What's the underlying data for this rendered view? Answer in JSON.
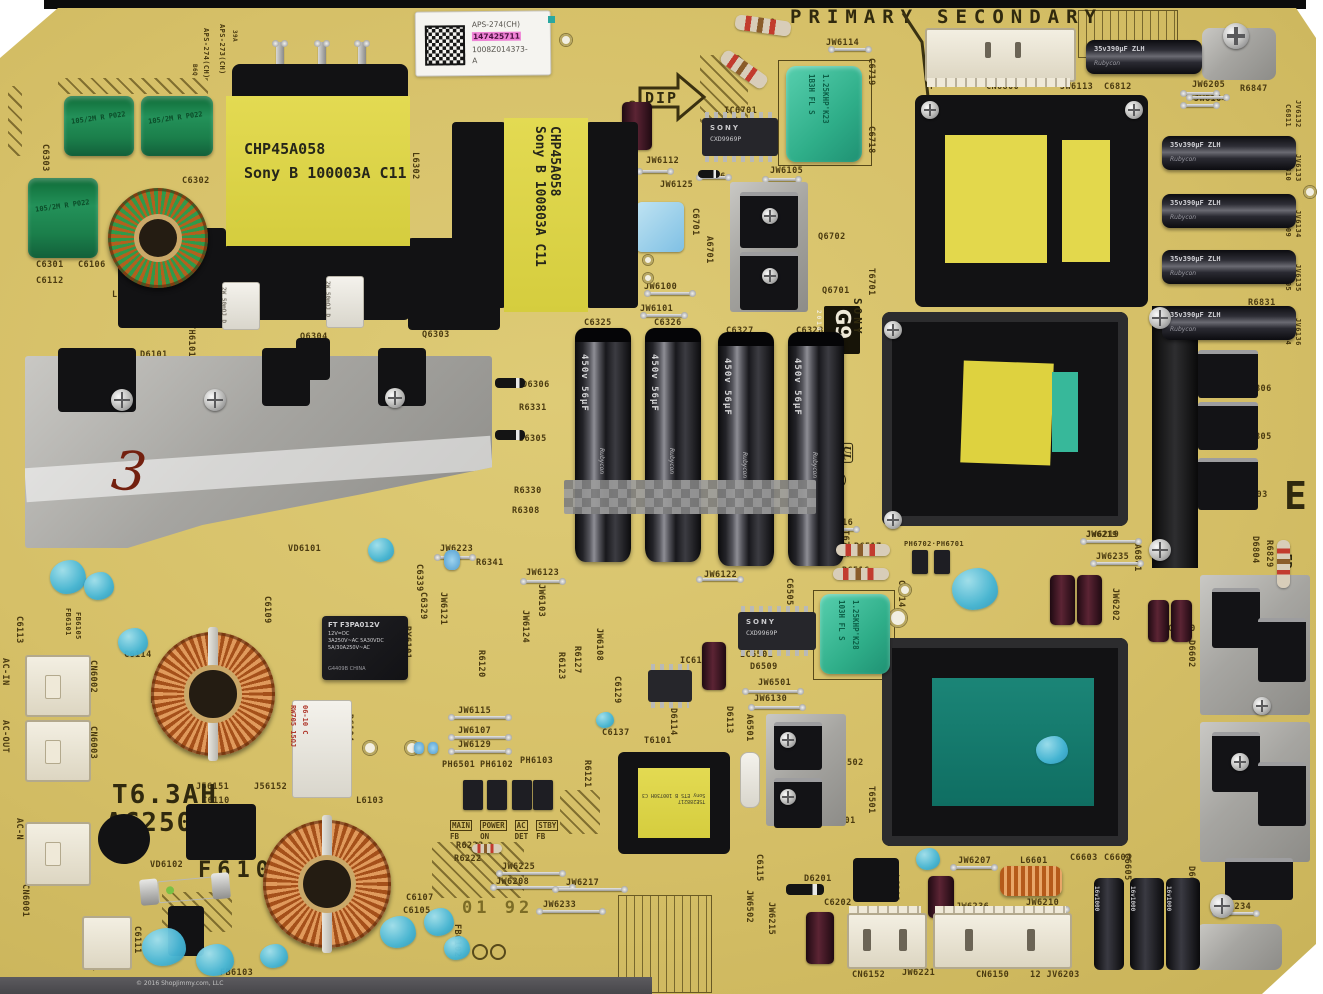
{
  "silk_large": {
    "primary": "PRIMARY",
    "secondary": "SECONDARY",
    "dip": "DIP",
    "big_e": "E",
    "edge_code": ">EP GW LP<",
    "fuse_rating": "T6.3AH",
    "fuse_voltage": "AC250V",
    "fuse_ref": "F6101",
    "date_stamp": "01 92",
    "g_block": {
      "g9": "G9",
      "year": "2010",
      "brand": "SONY",
      "model": "APS-273",
      "number": "1-882-846-11",
      "ul": "UL",
      "cert": "A"
    }
  },
  "sticker": {
    "line1": "APS-274(CH)",
    "serial": "147425711",
    "line3": "1008Z014373-",
    "line4": "A"
  },
  "handwriting": {
    "mark": "3"
  },
  "watermark": "© 2016 ShopJimmy.com, LLC",
  "components": {
    "t6302": {
      "line1": "CHP45A058",
      "line2": "Sony B 100003A C11"
    },
    "t6303": {
      "line1": "CHP45A058",
      "line2": "Sony B 100803A C11"
    },
    "t6101": {
      "line1": "TSE288217",
      "line2": "Sony ETS B 100730H C3"
    },
    "ic6701": {
      "brand": "SONY",
      "part": "CXD9969P"
    },
    "ic6501": {
      "brand": "SONY",
      "part": "CXD9969P"
    },
    "relay": {
      "l1": "FT F3PA012V",
      "l2": "12V=DC",
      "l3": "3A250V~AC  5A30VDC",
      "l4": "5A/30A250V~AC",
      "l5": "G4409B   CHINA"
    },
    "bulk_caps": {
      "brand": "Rubycon",
      "marking": "450v 56µF",
      "refs": [
        "C6325",
        "C6326",
        "C6327",
        "C6328"
      ]
    },
    "output_caps": {
      "brand": "Rubycon",
      "marking": "35v390µF",
      "series": "ZLH"
    },
    "small_caps": {
      "brand": "Rubycon",
      "marking": "16v1000"
    },
    "film_cap_marking": "105/2M R P022",
    "teal_cap_top": {
      "l1": "1B3H FL S",
      "l2": "1.25KHP'K23"
    },
    "teal_cap_mid": {
      "l1": "103H FL S",
      "l2": "1.25KHP'K28"
    },
    "power_resistor": "2W 50mΩJ D",
    "ceramic_resistor": {
      "l1": "RW705 15ΩJ",
      "l2": "06-10 C"
    }
  },
  "opto_labels": {
    "main": "MAIN",
    "fb1": "FB",
    "power": "POWER",
    "on": "ON",
    "ac": "AC",
    "det": "DET",
    "stby": "STBY",
    "fb2": "FB"
  },
  "silkscreen_labels": [
    {
      "t": "R6729",
      "x": 748,
      "y": 18
    },
    {
      "t": "JW6114",
      "x": 826,
      "y": 38
    },
    {
      "t": "C6719",
      "x": 876,
      "y": 58,
      "r": 90
    },
    {
      "t": "C6718",
      "x": 876,
      "y": 126,
      "r": 90
    },
    {
      "t": "L6303",
      "x": 958,
      "y": 38
    },
    {
      "t": "ET6801",
      "x": 1248,
      "y": 28,
      "r": 90
    },
    {
      "t": "↑",
      "x": 1212,
      "y": 52,
      "s": 13
    },
    {
      "t": "CN6800",
      "x": 986,
      "y": 82
    },
    {
      "t": "F",
      "x": 930,
      "y": 82
    },
    {
      "t": "JW6113",
      "x": 1060,
      "y": 82
    },
    {
      "t": "C6812",
      "x": 1104,
      "y": 82
    },
    {
      "t": "JW6205",
      "x": 1192,
      "y": 80
    },
    {
      "t": "R6847",
      "x": 1240,
      "y": 84
    },
    {
      "t": "JW6104",
      "x": 1194,
      "y": 94
    },
    {
      "t": "APS-273(CH)",
      "x": 226,
      "y": 24,
      "r": 90,
      "s": 7
    },
    {
      "t": "39A",
      "x": 238,
      "y": 30,
      "r": 90,
      "s": 6
    },
    {
      "t": "APS-274(CH)",
      "x": 210,
      "y": 28,
      "r": 90,
      "s": 7
    },
    {
      "t": "B6Q",
      "x": 198,
      "y": 64,
      "r": 90,
      "s": 6
    },
    {
      "t": "C6706",
      "x": 636,
      "y": 100,
      "r": 90
    },
    {
      "t": "IC6701",
      "x": 724,
      "y": 106
    },
    {
      "t": "JW6112",
      "x": 646,
      "y": 156
    },
    {
      "t": "D6706",
      "x": 698,
      "y": 172
    },
    {
      "t": "JW6125",
      "x": 660,
      "y": 180
    },
    {
      "t": "JW6105",
      "x": 770,
      "y": 166
    },
    {
      "t": "C6701",
      "x": 700,
      "y": 208,
      "r": 90
    },
    {
      "t": "A6701",
      "x": 714,
      "y": 236,
      "r": 90
    },
    {
      "t": "Q6702",
      "x": 818,
      "y": 232
    },
    {
      "t": "Q6701",
      "x": 822,
      "y": 286
    },
    {
      "t": "T6701",
      "x": 876,
      "y": 268,
      "r": 90
    },
    {
      "t": "JW6100",
      "x": 644,
      "y": 282
    },
    {
      "t": "JW6101",
      "x": 640,
      "y": 304
    },
    {
      "t": "R6597",
      "x": 588,
      "y": 334,
      "r": 90
    },
    {
      "t": "C6325",
      "x": 584,
      "y": 318
    },
    {
      "t": "C6326",
      "x": 654,
      "y": 318
    },
    {
      "t": "C6327",
      "x": 726,
      "y": 326
    },
    {
      "t": "C6328",
      "x": 796,
      "y": 326
    },
    {
      "t": "C6303",
      "x": 50,
      "y": 144,
      "r": 90
    },
    {
      "t": "C6302",
      "x": 182,
      "y": 176
    },
    {
      "t": "C6301",
      "x": 36,
      "y": 260
    },
    {
      "t": "C6106",
      "x": 78,
      "y": 260
    },
    {
      "t": "C6112",
      "x": 36,
      "y": 276
    },
    {
      "t": "L6301",
      "x": 112,
      "y": 290
    },
    {
      "t": "JW6117",
      "x": 172,
      "y": 292,
      "r": 90
    },
    {
      "t": "C6519",
      "x": 220,
      "y": 240,
      "r": 90
    },
    {
      "t": "C6518",
      "x": 232,
      "y": 258,
      "r": 90
    },
    {
      "t": "JW6120",
      "x": 266,
      "y": 268,
      "r": 90
    },
    {
      "t": "L6302",
      "x": 420,
      "y": 152,
      "r": 90
    },
    {
      "t": "JW6119",
      "x": 424,
      "y": 264,
      "r": 90
    },
    {
      "t": "R6304",
      "x": 482,
      "y": 286,
      "r": 90
    },
    {
      "t": "TH6101",
      "x": 196,
      "y": 324,
      "r": 90
    },
    {
      "t": "D6101",
      "x": 140,
      "y": 350
    },
    {
      "t": "Q6304",
      "x": 300,
      "y": 332
    },
    {
      "t": "Q6303",
      "x": 422,
      "y": 330
    },
    {
      "t": "D6306",
      "x": 522,
      "y": 380
    },
    {
      "t": "R6331",
      "x": 519,
      "y": 403
    },
    {
      "t": "D6305",
      "x": 519,
      "y": 434
    },
    {
      "t": "R6330",
      "x": 514,
      "y": 486
    },
    {
      "t": "R6308",
      "x": 512,
      "y": 506
    },
    {
      "t": "JW6223",
      "x": 440,
      "y": 544
    },
    {
      "t": "R6341",
      "x": 476,
      "y": 558
    },
    {
      "t": "JW6123",
      "x": 526,
      "y": 568
    },
    {
      "t": "C6339",
      "x": 424,
      "y": 564,
      "r": 90
    },
    {
      "t": "C6329",
      "x": 428,
      "y": 592,
      "r": 90
    },
    {
      "t": "JW6124",
      "x": 530,
      "y": 610,
      "r": 90
    },
    {
      "t": "JW6103",
      "x": 546,
      "y": 584,
      "r": 90
    },
    {
      "t": "JW6121",
      "x": 448,
      "y": 592,
      "r": 90
    },
    {
      "t": "VD6101",
      "x": 288,
      "y": 544
    },
    {
      "t": "C6109",
      "x": 272,
      "y": 596,
      "r": 90
    },
    {
      "t": "C6114",
      "x": 124,
      "y": 650
    },
    {
      "t": "C6113",
      "x": 24,
      "y": 616,
      "r": 90
    },
    {
      "t": "FB6101",
      "x": 72,
      "y": 608,
      "r": 90,
      "s": 7
    },
    {
      "t": "FB6105",
      "x": 82,
      "y": 612,
      "r": 90,
      "s": 7
    },
    {
      "t": "CN6002",
      "x": 98,
      "y": 660,
      "r": 90
    },
    {
      "t": "AC-IN",
      "x": 10,
      "y": 658,
      "r": 90
    },
    {
      "t": "CN6003",
      "x": 98,
      "y": 726,
      "r": 90
    },
    {
      "t": "AC-OUT",
      "x": 10,
      "y": 720,
      "r": 90
    },
    {
      "t": "AC-N",
      "x": 24,
      "y": 818,
      "r": 90
    },
    {
      "t": "AC-L",
      "x": 42,
      "y": 854,
      "r": 90
    },
    {
      "t": "CN6001",
      "x": 30,
      "y": 884,
      "r": 90
    },
    {
      "t": "L6101",
      "x": 150,
      "y": 696
    },
    {
      "t": "RY6101",
      "x": 412,
      "y": 626,
      "r": 90
    },
    {
      "t": "R6104",
      "x": 354,
      "y": 714,
      "r": 90
    },
    {
      "t": "J56151",
      "x": 196,
      "y": 782
    },
    {
      "t": "J56152",
      "x": 254,
      "y": 782
    },
    {
      "t": "C6110",
      "x": 202,
      "y": 796
    },
    {
      "t": "VD6102",
      "x": 150,
      "y": 860
    },
    {
      "t": "L6103",
      "x": 356,
      "y": 796
    },
    {
      "t": "FB6103",
      "x": 220,
      "y": 968
    },
    {
      "t": "ET6101",
      "x": 100,
      "y": 938,
      "r": 90
    },
    {
      "t": "C6111",
      "x": 142,
      "y": 926,
      "r": 90
    },
    {
      "t": "R6120",
      "x": 486,
      "y": 650,
      "r": 90
    },
    {
      "t": "JW6115",
      "x": 458,
      "y": 706
    },
    {
      "t": "JW6107",
      "x": 458,
      "y": 726
    },
    {
      "t": "JW6129",
      "x": 458,
      "y": 740
    },
    {
      "t": "PH6501",
      "x": 442,
      "y": 760
    },
    {
      "t": "PH6102",
      "x": 480,
      "y": 760
    },
    {
      "t": "PH6103",
      "x": 520,
      "y": 756
    },
    {
      "t": "R6223",
      "x": 456,
      "y": 841
    },
    {
      "t": "R6222",
      "x": 454,
      "y": 854
    },
    {
      "t": "JW6225",
      "x": 502,
      "y": 862
    },
    {
      "t": "JW6208",
      "x": 496,
      "y": 877
    },
    {
      "t": "JW6217",
      "x": 566,
      "y": 878
    },
    {
      "t": "JW6233",
      "x": 543,
      "y": 900
    },
    {
      "t": "FB6102",
      "x": 462,
      "y": 924,
      "r": 90
    },
    {
      "t": "C6107",
      "x": 406,
      "y": 893
    },
    {
      "t": "C6105",
      "x": 403,
      "y": 906
    },
    {
      "t": "C6137",
      "x": 602,
      "y": 728
    },
    {
      "t": "T6101",
      "x": 644,
      "y": 736
    },
    {
      "t": "R6121",
      "x": 592,
      "y": 760,
      "r": 90
    },
    {
      "t": "R6123",
      "x": 566,
      "y": 652,
      "r": 90
    },
    {
      "t": "R6127",
      "x": 582,
      "y": 646,
      "r": 90
    },
    {
      "t": "JW6108",
      "x": 604,
      "y": 628,
      "r": 90
    },
    {
      "t": "C6129",
      "x": 622,
      "y": 676,
      "r": 90
    },
    {
      "t": "IC6102",
      "x": 680,
      "y": 656
    },
    {
      "t": "D6114",
      "x": 678,
      "y": 708,
      "r": 90
    },
    {
      "t": "D6113",
      "x": 734,
      "y": 706,
      "r": 90
    },
    {
      "t": "A6501",
      "x": 754,
      "y": 714,
      "r": 90
    },
    {
      "t": "IC6501",
      "x": 740,
      "y": 650
    },
    {
      "t": "D6509",
      "x": 750,
      "y": 662
    },
    {
      "t": "JW6501",
      "x": 758,
      "y": 678
    },
    {
      "t": "JW6130",
      "x": 754,
      "y": 694
    },
    {
      "t": "Q6502",
      "x": 836,
      "y": 758
    },
    {
      "t": "Q6501",
      "x": 828,
      "y": 816
    },
    {
      "t": "T6501",
      "x": 876,
      "y": 786,
      "r": 90
    },
    {
      "t": "C6115",
      "x": 764,
      "y": 854,
      "r": 90
    },
    {
      "t": "JW6502",
      "x": 754,
      "y": 890,
      "r": 90
    },
    {
      "t": "JW6215",
      "x": 776,
      "y": 902,
      "r": 90
    },
    {
      "t": "D6201",
      "x": 804,
      "y": 874
    },
    {
      "t": "C6202",
      "x": 824,
      "y": 898
    },
    {
      "t": "L6201",
      "x": 900,
      "y": 874,
      "r": 90
    },
    {
      "t": "CN6152",
      "x": 852,
      "y": 970
    },
    {
      "t": "JW6221",
      "x": 902,
      "y": 968
    },
    {
      "t": "CN6150",
      "x": 976,
      "y": 970
    },
    {
      "t": "12 JV6203",
      "x": 1030,
      "y": 970
    },
    {
      "t": "JW6207",
      "x": 958,
      "y": 856
    },
    {
      "t": "JW6236",
      "x": 956,
      "y": 902
    },
    {
      "t": "L6601",
      "x": 1020,
      "y": 856
    },
    {
      "t": "JW6210",
      "x": 1026,
      "y": 898
    },
    {
      "t": "C6603",
      "x": 1070,
      "y": 853
    },
    {
      "t": "C6604",
      "x": 1104,
      "y": 853
    },
    {
      "t": "C6605",
      "x": 1132,
      "y": 853,
      "r": 90
    },
    {
      "t": "D6604",
      "x": 1196,
      "y": 866,
      "r": 90
    },
    {
      "t": "JW6234",
      "x": 1218,
      "y": 902
    },
    {
      "t": "ET6601",
      "x": 1208,
      "y": 926
    },
    {
      "t": "R6608",
      "x": 1182,
      "y": 940,
      "r": 90
    },
    {
      "t": "JW6116",
      "x": 820,
      "y": 518
    },
    {
      "t": "T6703",
      "x": 850,
      "y": 530,
      "r": 90
    },
    {
      "t": "R6517",
      "x": 854,
      "y": 542
    },
    {
      "t": "R6516",
      "x": 842,
      "y": 566
    },
    {
      "t": "PH6702·PH6701",
      "x": 904,
      "y": 540,
      "s": 7
    },
    {
      "t": "C6505",
      "x": 794,
      "y": 578,
      "r": 90
    },
    {
      "t": "C6514",
      "x": 906,
      "y": 580,
      "r": 90
    },
    {
      "t": "JW6122",
      "x": 704,
      "y": 570
    },
    {
      "t": "JW6219",
      "x": 1086,
      "y": 530
    },
    {
      "t": "JW6235",
      "x": 1096,
      "y": 552
    },
    {
      "t": "A6801",
      "x": 1142,
      "y": 544,
      "r": 90
    },
    {
      "t": "C6813",
      "x": 1098,
      "y": 576,
      "r": 90
    },
    {
      "t": "JW6202",
      "x": 1120,
      "y": 588,
      "r": 90
    },
    {
      "t": "C6820",
      "x": 1168,
      "y": 624
    },
    {
      "t": "JW6232",
      "x": 1248,
      "y": 596
    },
    {
      "t": "R6834",
      "x": 1226,
      "y": 604
    },
    {
      "t": "JW6109",
      "x": 1224,
      "y": 632
    },
    {
      "t": "D6602",
      "x": 1196,
      "y": 640,
      "r": 90
    },
    {
      "t": "A6601",
      "x": 1302,
      "y": 660,
      "r": 90
    },
    {
      "t": "A6602",
      "x": 1302,
      "y": 792,
      "r": 90
    },
    {
      "t": "D6806",
      "x": 1244,
      "y": 384
    },
    {
      "t": "D6805",
      "x": 1244,
      "y": 432
    },
    {
      "t": "D6803",
      "x": 1240,
      "y": 490
    },
    {
      "t": "D6804",
      "x": 1260,
      "y": 536,
      "r": 90
    },
    {
      "t": "R6829",
      "x": 1274,
      "y": 540,
      "r": 90
    },
    {
      "t": "R6831",
      "x": 1248,
      "y": 298
    },
    {
      "t": "JV6132",
      "x": 1302,
      "y": 100,
      "r": 90,
      "s": 7
    },
    {
      "t": "C6811",
      "x": 1292,
      "y": 104,
      "r": 90,
      "s": 7
    },
    {
      "t": "JV6133",
      "x": 1302,
      "y": 154,
      "r": 90,
      "s": 7
    },
    {
      "t": "C6810",
      "x": 1292,
      "y": 158,
      "r": 90,
      "s": 7
    },
    {
      "t": "JV6134",
      "x": 1302,
      "y": 210,
      "r": 90,
      "s": 7
    },
    {
      "t": "C6809",
      "x": 1292,
      "y": 214,
      "r": 90,
      "s": 7
    },
    {
      "t": "JV6135",
      "x": 1302,
      "y": 264,
      "r": 90,
      "s": 7
    },
    {
      "t": "C6805",
      "x": 1292,
      "y": 268,
      "r": 90,
      "s": 7
    },
    {
      "t": "JV6136",
      "x": 1302,
      "y": 318,
      "r": 90,
      "s": 7
    },
    {
      "t": "C6804",
      "x": 1292,
      "y": 322,
      "r": 90,
      "s": 7
    },
    {
      "t": "JW6219",
      "x": 1086,
      "y": 530,
      "s": 8
    }
  ]
}
